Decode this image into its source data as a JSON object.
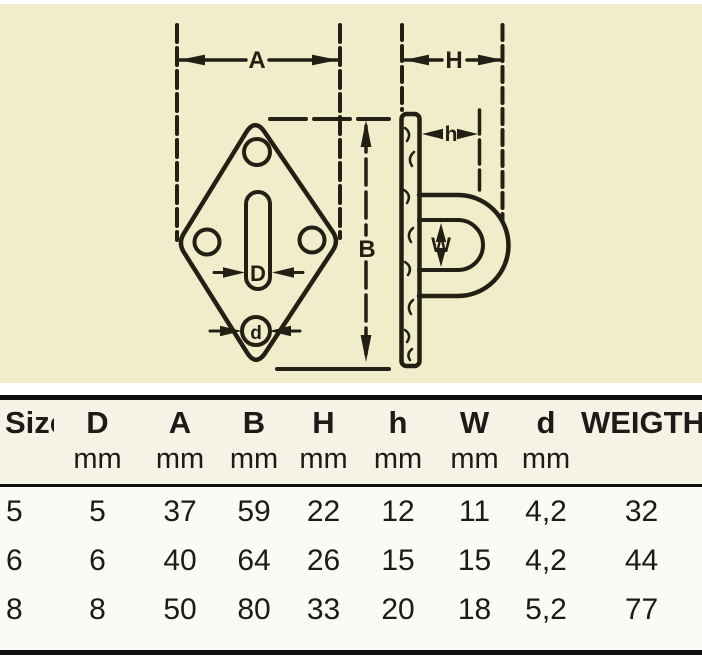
{
  "colors": {
    "panel_bg": "#f1edcb",
    "header_bg": "#f5f2e6",
    "data_bg": "#fbfaf6",
    "rule": "#0e0e0c",
    "ink": "#221f14",
    "text": "#1c1b17",
    "page_bg": "#ffffff"
  },
  "drawing": {
    "labels": {
      "A": "A",
      "B": "B",
      "D": "D",
      "H": "H",
      "h": "h",
      "W": "W",
      "d": "d"
    }
  },
  "table": {
    "columns": [
      {
        "label": "Size",
        "unit": ""
      },
      {
        "label": "D",
        "unit": "mm"
      },
      {
        "label": "A",
        "unit": "mm"
      },
      {
        "label": "B",
        "unit": "mm"
      },
      {
        "label": "H",
        "unit": "mm"
      },
      {
        "label": "h",
        "unit": "mm"
      },
      {
        "label": "W",
        "unit": "mm"
      },
      {
        "label": "d",
        "unit": "mm"
      },
      {
        "label": "WEIGTH",
        "unit": ""
      }
    ],
    "rows": [
      [
        "5",
        "5",
        "37",
        "59",
        "22",
        "12",
        "11",
        "4,2",
        "32"
      ],
      [
        "6",
        "6",
        "40",
        "64",
        "26",
        "15",
        "15",
        "4,2",
        "44"
      ],
      [
        "8",
        "8",
        "50",
        "80",
        "33",
        "20",
        "18",
        "5,2",
        "77"
      ]
    ]
  }
}
